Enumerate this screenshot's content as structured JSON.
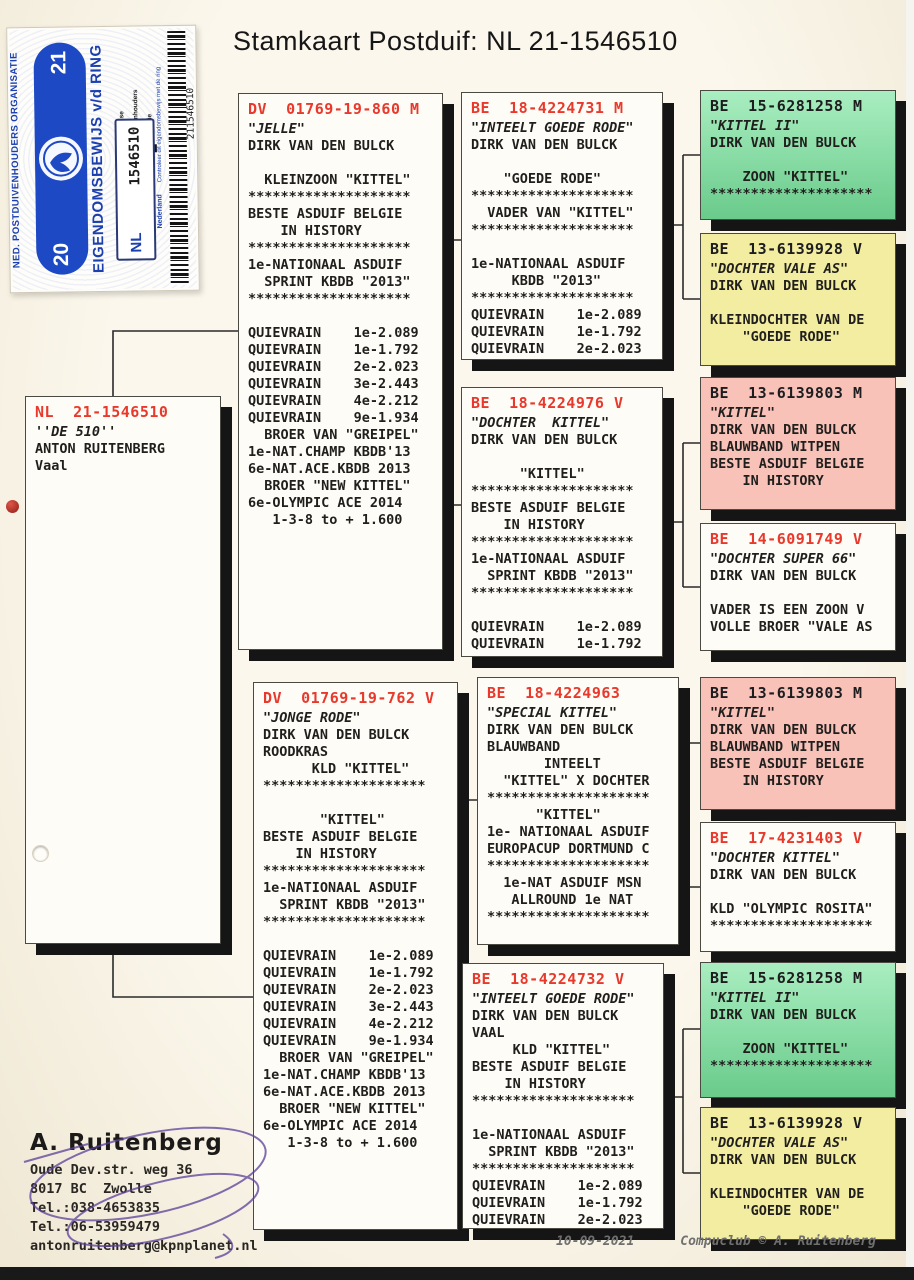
{
  "title": "Stamkaart Postduif: NL  21-1546510",
  "colors": {
    "white": "#fdfcf6",
    "green": "#84e6a5",
    "yellow": "#f2eda0",
    "pink": "#f9c2b9",
    "red": "#e8392c",
    "black": "#1d1d1f"
  },
  "sticker": {
    "org_name": "NED. POSTDUIVENHOUDERS ORGANISATIE",
    "ownership_title": "EIGENDOMSBEWIJS v/d RING",
    "year_parts": [
      "20",
      "21"
    ],
    "country": "NL",
    "ring_number": "1546510",
    "barcode_number": "211546510",
    "country_label": "Nederland",
    "check_text": "Controleer dit eigendomsbewijs met de ring",
    "legend": [
      "Nederlandse",
      "Postduivenhouders",
      "Organisatie"
    ]
  },
  "boxes": [
    {
      "id": "subject",
      "ring": "NL  21-1546510",
      "ring_color": "red",
      "name": "''DE 510''",
      "bg": "white",
      "lines": [
        "ANTON RUITENBERG",
        "Vaal"
      ]
    },
    {
      "id": "father",
      "ring": "DV  01769-19-860 M",
      "ring_color": "red",
      "name": "\"JELLE\"",
      "bg": "white",
      "lines": [
        "DIRK VAN DEN BULCK",
        "",
        "  KLEINZOON \"KITTEL\"",
        "********************",
        "BESTE ASDUIF BELGIE",
        "    IN HISTORY",
        "********************",
        "1e-NATIONAAL ASDUIF",
        "  SPRINT KBDB \"2013\"",
        "********************",
        "",
        "QUIEVRAIN    1e-2.089",
        "QUIEVRAIN    1e-1.792",
        "QUIEVRAIN    2e-2.023",
        "QUIEVRAIN    3e-2.443",
        "QUIEVRAIN    4e-2.212",
        "QUIEVRAIN    9e-1.934",
        "  BROER VAN \"GREIPEL\"",
        "1e-NAT.CHAMP KBDB'13",
        "6e-NAT.ACE.KBDB 2013",
        "  BROER \"NEW KITTEL\"",
        "6e-OLYMPIC ACE 2014",
        "   1-3-8 to + 1.600"
      ]
    },
    {
      "id": "mother",
      "ring": "DV  01769-19-762 V",
      "ring_color": "red",
      "name": "\"JONGE RODE\"",
      "bg": "white",
      "lines": [
        "DIRK VAN DEN BULCK",
        "ROODKRAS",
        "      KLD \"KITTEL\"",
        "********************",
        "",
        "       \"KITTEL\"",
        "BESTE ASDUIF BELGIE",
        "    IN HISTORY",
        "********************",
        "1e-NATIONAAL ASDUIF",
        "  SPRINT KBDB \"2013\"",
        "********************",
        "",
        "QUIEVRAIN    1e-2.089",
        "QUIEVRAIN    1e-1.792",
        "QUIEVRAIN    2e-2.023",
        "QUIEVRAIN    3e-2.443",
        "QUIEVRAIN    4e-2.212",
        "QUIEVRAIN    9e-1.934",
        "  BROER VAN \"GREIPEL\"",
        "1e-NAT.CHAMP KBDB'13",
        "6e-NAT.ACE.KBDB 2013",
        "  BROER \"NEW KITTEL\"",
        "6e-OLYMPIC ACE 2014",
        "   1-3-8 to + 1.600"
      ]
    },
    {
      "id": "gp1",
      "ring": "BE  18-4224731 M",
      "ring_color": "red",
      "name": "\"INTEELT GOEDE RODE\"",
      "bg": "white",
      "lines": [
        "DIRK VAN DEN BULCK",
        "",
        "    \"GOEDE RODE\"",
        "********************",
        "  VADER VAN \"KITTEL\"",
        "********************",
        "",
        "1e-NATIONAAL ASDUIF",
        "     KBDB \"2013\"",
        "********************",
        "QUIEVRAIN    1e-2.089",
        "QUIEVRAIN    1e-1.792",
        "QUIEVRAIN    2e-2.023"
      ]
    },
    {
      "id": "gp2",
      "ring": "BE  18-4224976 V",
      "ring_color": "red",
      "name": "\"DOCHTER  KITTEL\"",
      "bg": "white",
      "lines": [
        "DIRK VAN DEN BULCK",
        "",
        "      \"KITTEL\"",
        "********************",
        "BESTE ASDUIF BELGIE",
        "    IN HISTORY",
        "********************",
        "1e-NATIONAAL ASDUIF",
        "  SPRINT KBDB \"2013\"",
        "********************",
        "",
        "QUIEVRAIN    1e-2.089",
        "QUIEVRAIN    1e-1.792"
      ]
    },
    {
      "id": "gp3",
      "ring": "BE  18-4224963",
      "ring_color": "red",
      "name": "\"SPECIAL KITTEL\"",
      "bg": "white",
      "lines": [
        "DIRK VAN DEN BULCK",
        "BLAUWBAND",
        "       INTEELT",
        "  \"KITTEL\" X DOCHTER",
        "********************",
        "      \"KITTEL\"",
        "1e- NATIONAAL ASDUIF",
        "EUROPACUP DORTMUND C",
        "********************",
        "  1e-NAT ASDUIF MSN",
        "   ALLROUND 1e NAT",
        "********************"
      ]
    },
    {
      "id": "gp4",
      "ring": "BE  18-4224732 V",
      "ring_color": "red",
      "name": "\"INTEELT GOEDE RODE\"",
      "bg": "white",
      "lines": [
        "DIRK VAN DEN BULCK",
        "VAAL",
        "     KLD \"KITTEL\"",
        "BESTE ASDUIF BELGIE",
        "    IN HISTORY",
        "********************",
        "",
        "1e-NATIONAAL ASDUIF",
        "  SPRINT KBDB \"2013\"",
        "********************",
        "QUIEVRAIN    1e-2.089",
        "QUIEVRAIN    1e-1.792",
        "QUIEVRAIN    2e-2.023"
      ]
    },
    {
      "id": "ggp1",
      "ring": "BE  15-6281258 M",
      "ring_color": "black",
      "name": "\"KITTEL II\"",
      "bg": "green",
      "lines": [
        "DIRK VAN DEN BULCK",
        "",
        "    ZOON \"KITTEL\"",
        "********************"
      ]
    },
    {
      "id": "ggp2",
      "ring": "BE  13-6139928 V",
      "ring_color": "black",
      "name": "\"DOCHTER VALE AS\"",
      "bg": "yellow",
      "lines": [
        "DIRK VAN DEN BULCK",
        "",
        "KLEINDOCHTER VAN DE",
        "    \"GOEDE RODE\""
      ]
    },
    {
      "id": "ggp3",
      "ring": "BE  13-6139803 M",
      "ring_color": "black",
      "name": "\"KITTEL\"",
      "bg": "pink",
      "lines": [
        "DIRK VAN DEN BULCK",
        "BLAUWBAND WITPEN",
        "BESTE ASDUIF BELGIE",
        "    IN HISTORY"
      ]
    },
    {
      "id": "ggp4",
      "ring": "BE  14-6091749 V",
      "ring_color": "red",
      "name": "\"DOCHTER SUPER 66\"",
      "bg": "white",
      "lines": [
        "DIRK VAN DEN BULCK",
        "",
        "VADER IS EEN ZOON V",
        "VOLLE BROER \"VALE AS"
      ]
    },
    {
      "id": "ggp5",
      "ring": "BE  13-6139803 M",
      "ring_color": "black",
      "name": "\"KITTEL\"",
      "bg": "pink",
      "lines": [
        "DIRK VAN DEN BULCK",
        "BLAUWBAND WITPEN",
        "BESTE ASDUIF BELGIE",
        "    IN HISTORY"
      ]
    },
    {
      "id": "ggp6",
      "ring": "BE  17-4231403 V",
      "ring_color": "red",
      "name": "\"DOCHTER KITTEL\"",
      "bg": "white",
      "lines": [
        "DIRK VAN DEN BULCK",
        "",
        "KLD \"OLYMPIC ROSITA\"",
        "********************"
      ]
    },
    {
      "id": "ggp7",
      "ring": "BE  15-6281258 M",
      "ring_color": "black",
      "name": "\"KITTEL II\"",
      "bg": "green",
      "lines": [
        "DIRK VAN DEN BULCK",
        "",
        "    ZOON \"KITTEL\"",
        "********************"
      ]
    },
    {
      "id": "ggp8",
      "ring": "BE  13-6139928 V",
      "ring_color": "black",
      "name": "\"DOCHTER VALE AS\"",
      "bg": "yellow",
      "lines": [
        "DIRK VAN DEN BULCK",
        "",
        "KLEINDOCHTER VAN DE",
        "    \"GOEDE RODE\""
      ]
    }
  ],
  "owner": {
    "name": "A. Ruitenberg",
    "lines": [
      "Oude Dev.str. weg 36",
      "8017 BC  Zwolle",
      "Tel.:038-4653835",
      "Tel.:06-53959479",
      "antonruitenberg@kpnplanet.nl"
    ]
  },
  "footer": {
    "date": "10-09-2021",
    "credit": "Compuclub © A. Ruitenberg"
  }
}
